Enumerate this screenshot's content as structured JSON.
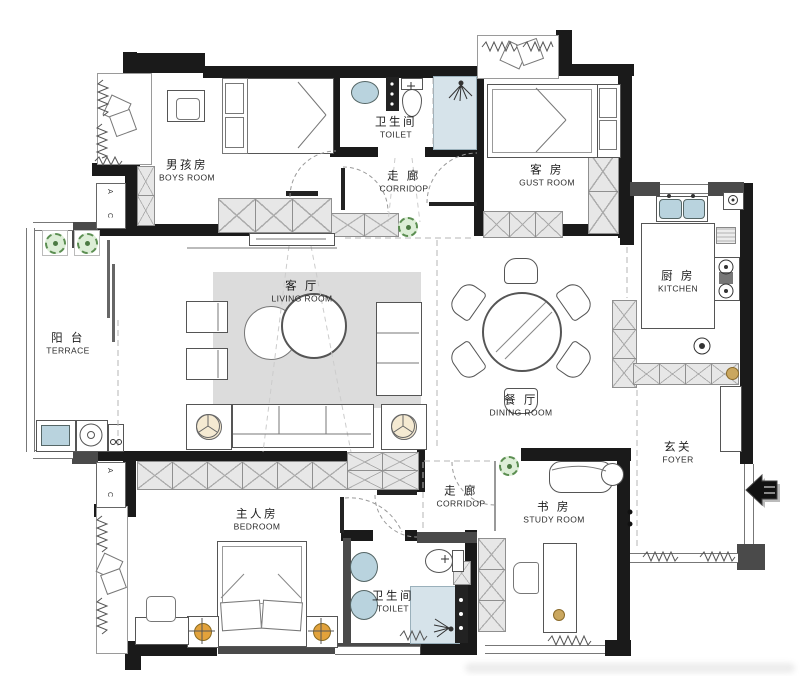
{
  "rooms": {
    "boys_room": {
      "zh": "男孩房",
      "en": "BOYS ROOM"
    },
    "toilet_top": {
      "zh": "卫生间",
      "en": "TOILET"
    },
    "corridor_top": {
      "zh": "走 廊",
      "en": "CORRIDOP"
    },
    "guest_room": {
      "zh": "客 房",
      "en": "GUST ROOM"
    },
    "kitchen": {
      "zh": "厨 房",
      "en": "KITCHEN"
    },
    "terrace": {
      "zh": "阳 台",
      "en": "TERRACE"
    },
    "living_room": {
      "zh": "客 厅",
      "en": "LIVING ROOM"
    },
    "dining_room": {
      "zh": "餐 厅",
      "en": "DINING ROOM"
    },
    "foyer": {
      "zh": "玄关",
      "en": "FOYER"
    },
    "bedroom": {
      "zh": "主人房",
      "en": "BEDROOM"
    },
    "corridor_bottom": {
      "zh": "走 廊",
      "en": "CORRIDOP"
    },
    "toilet_bottom": {
      "zh": "卫生间",
      "en": "TOILET"
    },
    "study_room": {
      "zh": "书 房",
      "en": "STUDY ROOM"
    }
  },
  "labels": {
    "ac_a": "A",
    "ac_c": "C"
  },
  "colors": {
    "wall": "#1a1a1a",
    "wall_gray": "#4a4a4a",
    "hatch_fill": "#e7e7e7",
    "hatch_line": "#ababab",
    "rug_gray": "#dcdcdc",
    "water_blue": "#b9d3de",
    "shower_blue": "#d6e3ea",
    "plant_green": "#5c8f52",
    "lamp_orange": "#e2a23b",
    "knob_gold": "#caa75f"
  }
}
